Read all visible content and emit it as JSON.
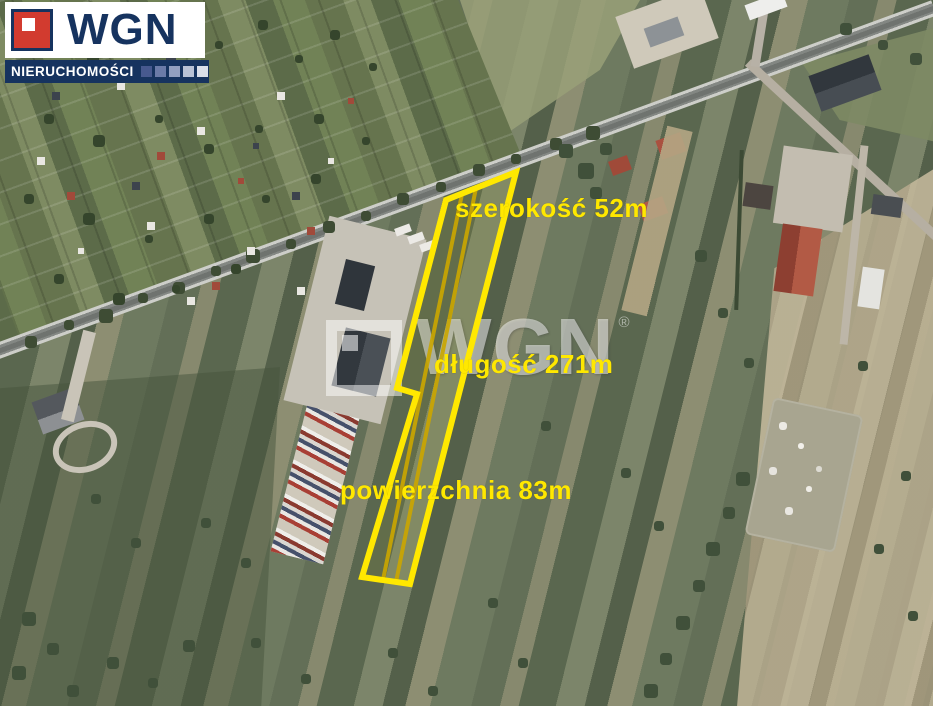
{
  "logo": {
    "brand": "WGN",
    "subtitle": "NIERUCHOMOŚCI",
    "brand_color": "#16335f",
    "accent_red": "#d23b2f",
    "squares": [
      "#47598f",
      "#6b7ba8",
      "#93a0c0",
      "#b9c2d6",
      "#dadfea"
    ]
  },
  "watermark": {
    "text": "WGN",
    "registered": "®"
  },
  "annotations": {
    "width_label": "szerokość 52m",
    "length_label": "długość 271m",
    "area_label": "powierzchnia 83m",
    "label_color": "#ffe800"
  },
  "plot": {
    "outline_color": "#ffe800",
    "divider_color": "#c9a400"
  }
}
